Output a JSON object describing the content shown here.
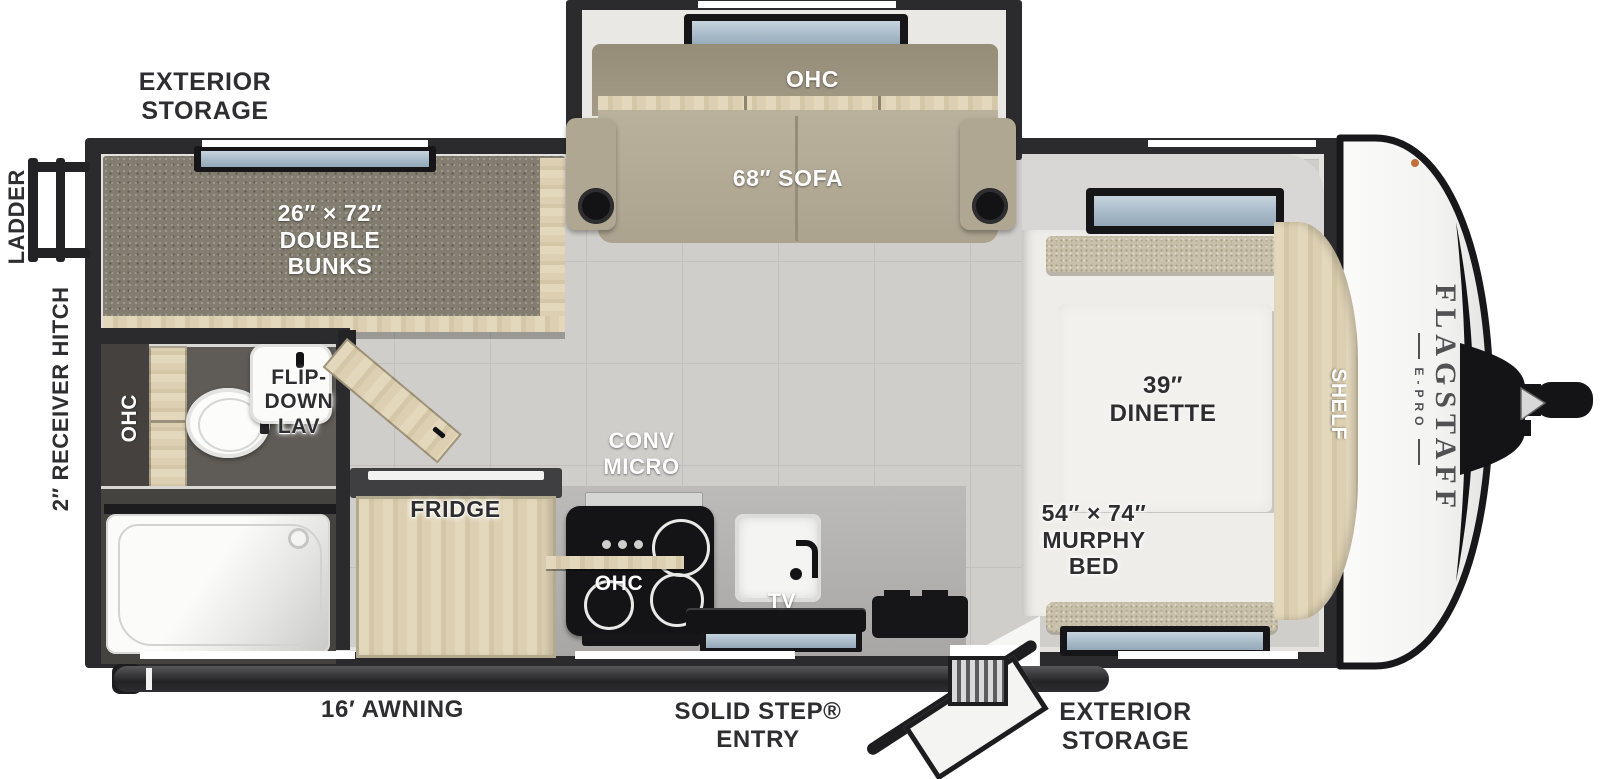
{
  "title": "Flagstaff E-Pro travel trailer floor plan",
  "brand": {
    "name": "FLAGSTAFF",
    "series": "E-PRO"
  },
  "labels": {
    "exterior_storage_rear": "EXTERIOR\nSTORAGE",
    "ladder": "LADDER",
    "receiver_hitch": "2″ RECEIVER HITCH",
    "double_bunks": "26″ × 72″\nDOUBLE\nBUNKS",
    "ohc_sofa": "OHC",
    "sofa": "68″ SOFA",
    "ohc_bathroom": "OHC",
    "flip_down_lav": "FLIP-\nDOWN\nLAV",
    "conv_micro": "CONV\nMICRO",
    "fridge": "FRIDGE",
    "ohc_kitchen": "OHC",
    "tv": "TV",
    "dinette": "39″\nDINETTE",
    "shelf": "SHELF",
    "murphy_bed": "54″ × 74″\nMURPHY\nBED",
    "awning": "16′ AWNING",
    "solid_step_entry": "SOLID STEP®\nENTRY",
    "exterior_storage_front": "EXTERIOR\nSTORAGE"
  },
  "colors": {
    "wall": "#2b2b2d",
    "floor": "#d0cecb",
    "floor_grout": "#c2c0bc",
    "bunk_carpet": "#827d6f",
    "bath_floor": "#5f5b56",
    "wood": "#ddd0b2",
    "sofa": "#b4ab97",
    "sofa_back": "#a49b87",
    "white_surface": "#f1f0ed",
    "counter": "#b5b4b2",
    "appliance_black": "#161618",
    "window_glass": "#aec0cd",
    "label_dark": "#2e2e30",
    "label_light": "#ffffff",
    "nose_cap": "#f7f7f6",
    "brand_text": "#515153",
    "cushion_tan": "#c9c0a9",
    "marker_light": "#c2703b"
  }
}
